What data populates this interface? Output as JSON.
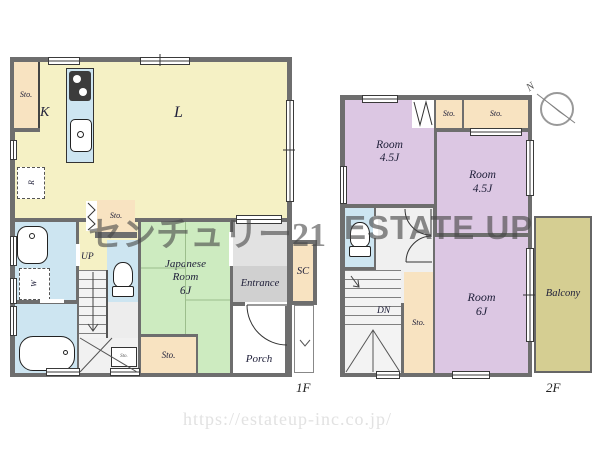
{
  "watermark": {
    "brand_jp": "センチュリー21",
    "brand_en": "ESTATE UP",
    "url": "https://estateup-inc.co.jp/"
  },
  "floor1": {
    "label": "1F",
    "rooms": {
      "living": "L",
      "kitchen": "K",
      "japanese": {
        "l1": "Japanese",
        "l2": "Room",
        "size": "6J"
      },
      "entrance": "Entrance",
      "porch": "Porch",
      "shoe_closet": "SC"
    },
    "fixtures": {
      "fridge": "R",
      "washer": "W"
    },
    "storage": {
      "top_left": "Sto.",
      "hall": "Sto.",
      "tatami": "Sto.",
      "under_stairs": "Sto."
    },
    "stairs": {
      "up": "UP"
    }
  },
  "floor2": {
    "label": "2F",
    "rooms": {
      "a": {
        "name": "Room",
        "size": "4.5J"
      },
      "b": {
        "name": "Room",
        "size": "4.5J"
      },
      "c": {
        "name": "Room",
        "size": "6J"
      },
      "balcony": "Balcony"
    },
    "storage": {
      "top_a": "Sto.",
      "top_b": "Sto.",
      "hall": "Sto."
    },
    "stairs": {
      "down": "DN"
    },
    "compass": {
      "north": "N"
    }
  },
  "colors": {
    "wall": "#6e6e6e",
    "ldk": "#f5f1c5",
    "storage": "#f8e3c1",
    "tatami": "#cdebc0",
    "water": "#cde5f1",
    "bedroom": "#dcc7e3",
    "balcony": "#d5ce92",
    "entrance": "#d0d0d0"
  }
}
